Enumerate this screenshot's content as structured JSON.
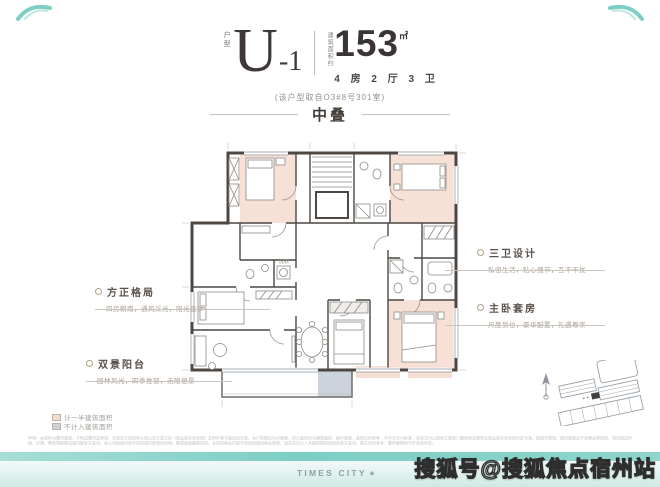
{
  "header": {
    "unit_label": "户型",
    "unit_main": "U",
    "unit_suffix": "-1",
    "area_label": "建筑面积约",
    "area_value": "153",
    "area_unit": "㎡",
    "rooms_summary": "4 房 2 厅 3 卫",
    "source_note": "(该户型取自O3#8号301室)",
    "section_title": "中叠"
  },
  "annotations": {
    "left": [
      {
        "title": "方正格局",
        "desc": "四房朝南，通风采光，阳光直享"
      },
      {
        "title": "双景阳台",
        "desc": "园林风光，四季推窗，无限憩景"
      }
    ],
    "right": [
      {
        "title": "三卫设计",
        "desc": "私密生活，贴心细节，互不干扰"
      },
      {
        "title": "主卧套房",
        "desc": "尺度到位，豪华配置，礼遇尊崇"
      }
    ]
  },
  "floorplan": {
    "room_labels": [
      {
        "text": "洗衣"
      }
    ]
  },
  "legend": {
    "items": [
      {
        "label": "计一半建筑面积",
        "color": "#f5dccf"
      },
      {
        "label": "不计入建筑面积",
        "color": "#ccd3dc"
      }
    ]
  },
  "footer": {
    "disclaimer": "声明：本资料为要约邀请，不构成要约或承诺，买卖双方的权利义务以双方签订的《商品房买卖合同》及附件等书面协议为准。本户型图仅为示意图，所示面积均为建筑面积，图中家具、装饰仅供参考，不作为交付标准，实际交付以政府主管部门最终审定图纸及商品房买卖合同约定为准。因城市规划、政府政策及开发建设等原因，项目周边环境、交通、教育等配套设施可能发生变化，本公司保留对宣传资料进行修改的权利，敬请留意最新资料。本资料相关内容不排除因政府相关规划、规定及出让人未能控制的原因而发生变化。图文仅供参考，最终解释权归开发商所有。",
    "brand": "TIMES CITY",
    "watermark": "搜狐号@搜狐焦点宿州站"
  },
  "colors": {
    "accent_teal": "#84d0c7",
    "wall_dark": "#4c4742",
    "room_peach": "#f7e1d6",
    "terrace_gray": "#ccd3dc",
    "title_dark": "#3f3a38"
  }
}
